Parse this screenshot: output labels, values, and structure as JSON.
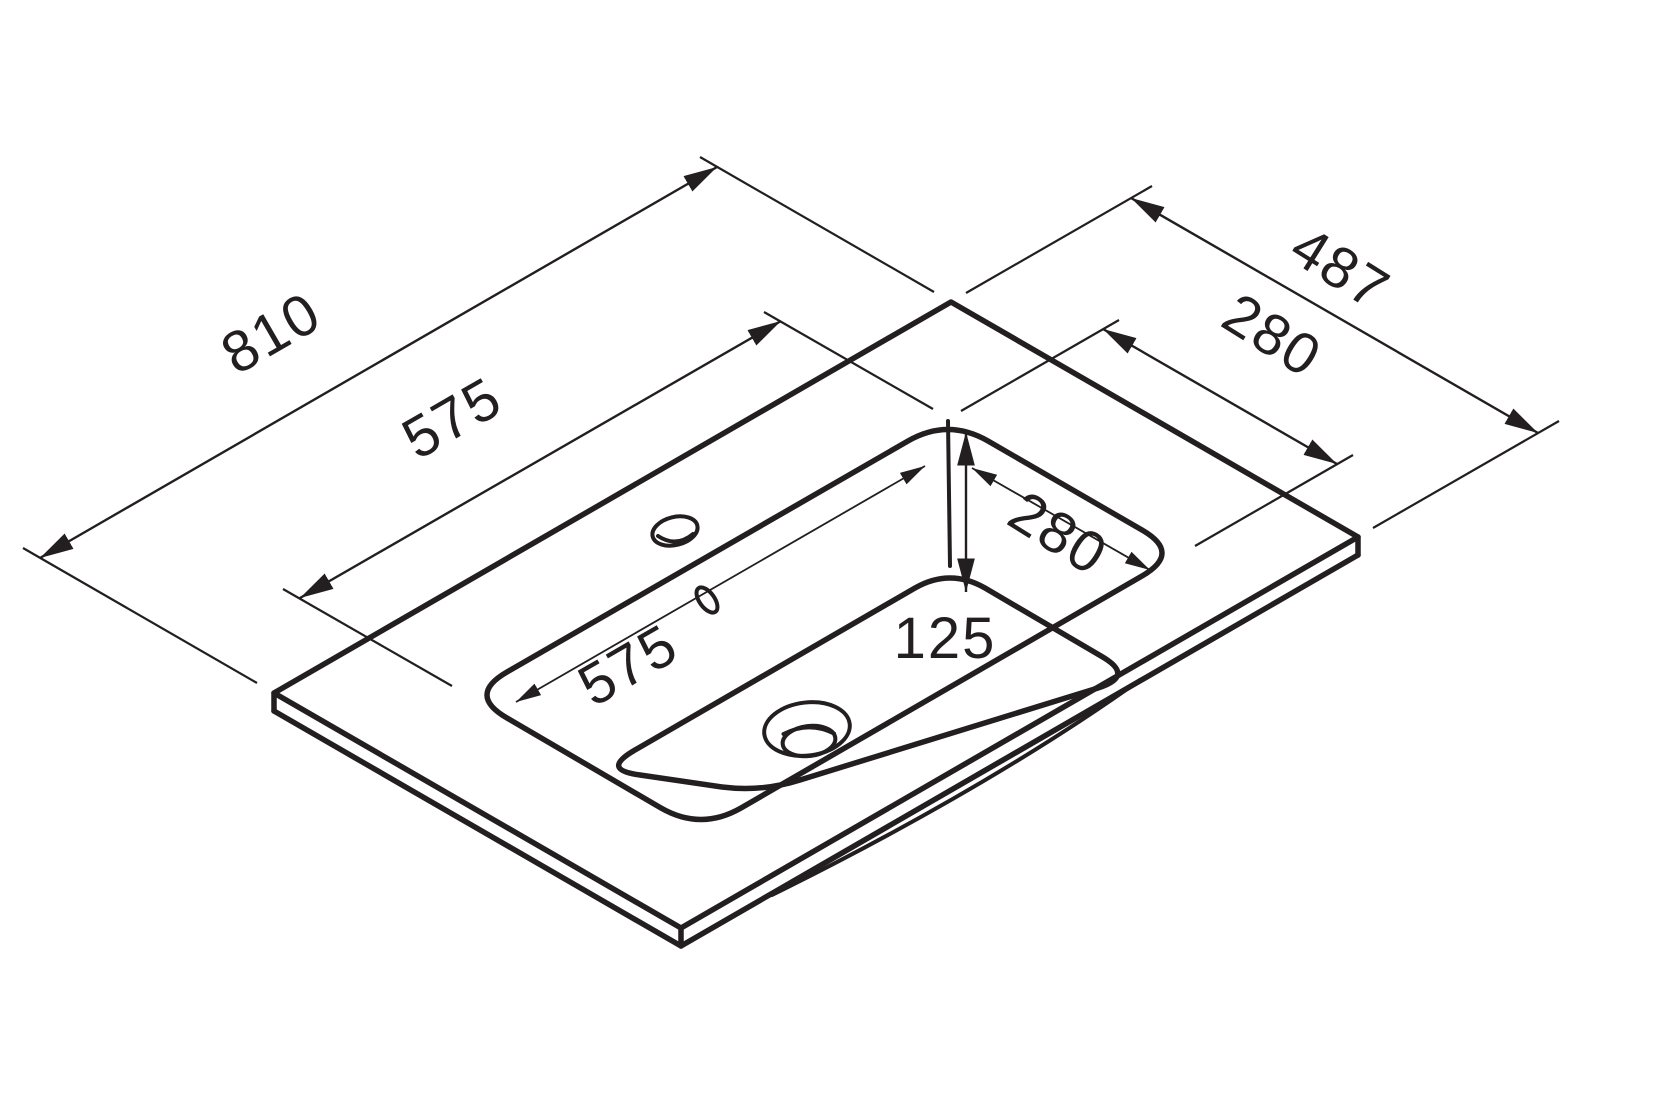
{
  "drawing": {
    "subject": "washbasin-countertop-isometric-dimension-drawing",
    "line_color": "#231f20",
    "background_color": "#ffffff",
    "labels": {
      "overall_width": "810",
      "overall_depth": "487",
      "basin_opening_width": "575",
      "basin_opening_depth": "280",
      "basin_inner_width": "575",
      "basin_inner_depth": "280",
      "basin_depth": "125"
    }
  }
}
